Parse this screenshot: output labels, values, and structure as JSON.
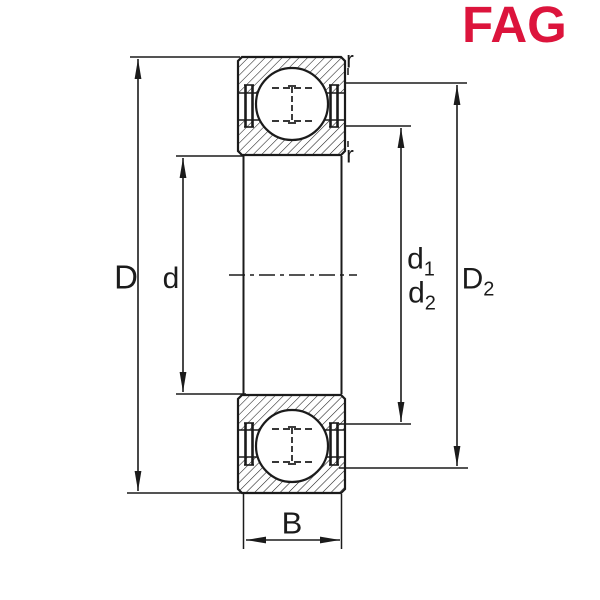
{
  "logo": {
    "text": "FAG",
    "color": "#DC143C"
  },
  "colors": {
    "line": "#1b1b1b",
    "background": "#ffffff"
  },
  "labels": {
    "D": "D",
    "d": "d",
    "d1": {
      "base": "d",
      "sub": "1"
    },
    "d2": {
      "base": "d",
      "sub": "2"
    },
    "D2": {
      "base": "D",
      "sub": "2"
    },
    "B": "B",
    "r_outer": "r",
    "r_inner": "r"
  }
}
